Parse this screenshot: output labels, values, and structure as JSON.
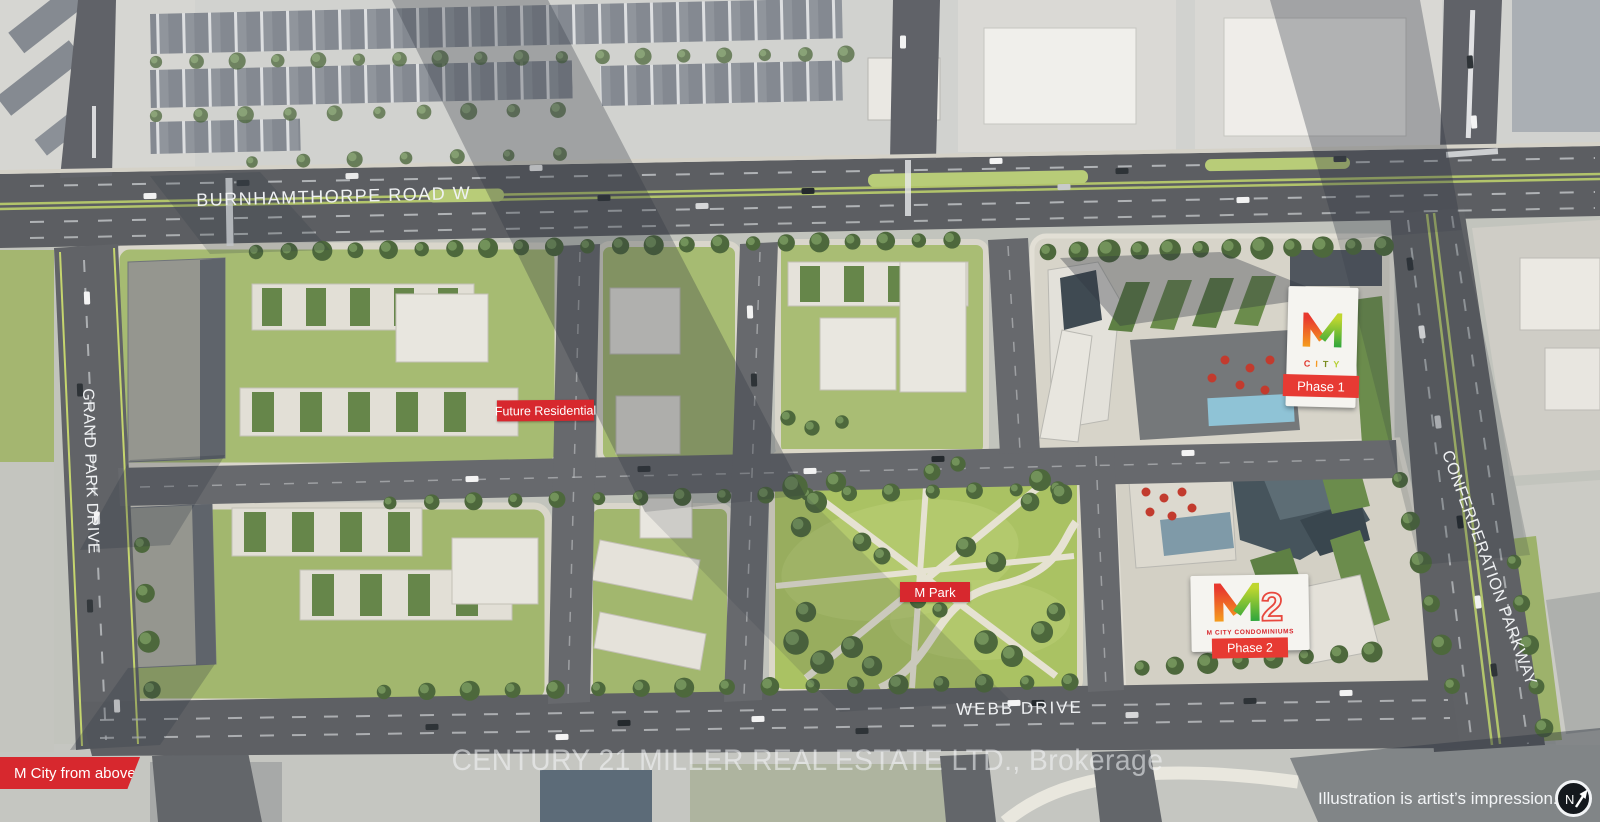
{
  "roads": {
    "burnhamthorpe": {
      "label": "BURNHAMTHORPE ROAD W"
    },
    "grand_park": {
      "label": "GRAND PARK DRIVE"
    },
    "confederation": {
      "label": "CONFERDERATION PARKWAY"
    },
    "webb": {
      "label": "WEBB DRIVE"
    }
  },
  "map_labels": {
    "future_residential": "Future Residential",
    "m_park": "M Park",
    "m_city_from_above": "M City from above"
  },
  "phase1_sign": {
    "logo_letters": [
      {
        "ch": "C",
        "color": "#e0352c"
      },
      {
        "ch": "I",
        "color": "#f59a23"
      },
      {
        "ch": "T",
        "color": "#7a8c1e"
      },
      {
        "ch": "Y",
        "color": "#b5cf31"
      }
    ],
    "banner": "Phase 1"
  },
  "phase2_sign": {
    "logo_number": "2",
    "subtitle": "M CITY CONDOMINIUMS",
    "banner": "Phase 2"
  },
  "watermark": {
    "text": "CENTURY 21 MILLER REAL ESTATE LTD., Brokerage"
  },
  "disclaimer": {
    "text": "Illustration is artist’s impression."
  },
  "compass": {
    "label": "N"
  },
  "colors": {
    "label_red": "#d7282e",
    "banner_red": "#e73a33",
    "logo_red": "#e8392e",
    "logo_orange": "#f59d1e",
    "logo_green_light": "#bfd62f",
    "logo_green_dark": "#2fa63c"
  }
}
